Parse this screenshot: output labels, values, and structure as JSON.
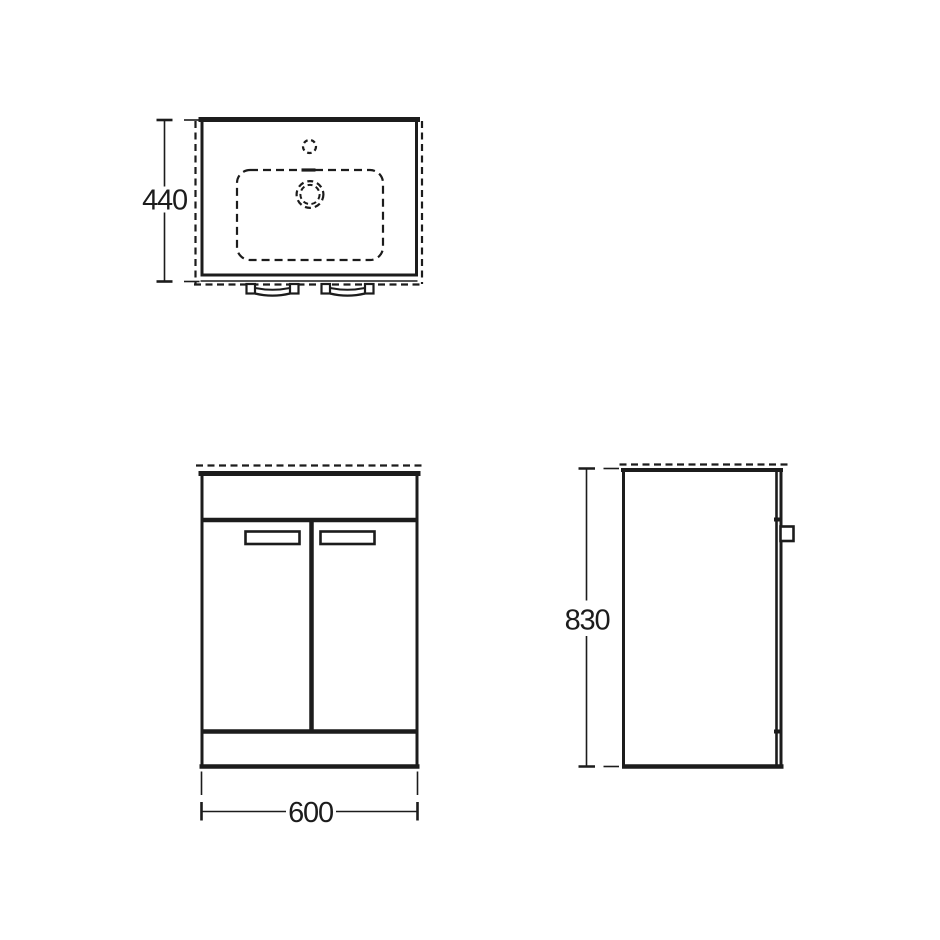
{
  "drawing": {
    "background_color": "#ffffff",
    "line_color": "#1c1c1c",
    "views": {
      "plan": {
        "dimension_label": "440"
      },
      "front": {
        "dimension_label": "600"
      },
      "side": {
        "dimension_label": "830"
      }
    }
  }
}
